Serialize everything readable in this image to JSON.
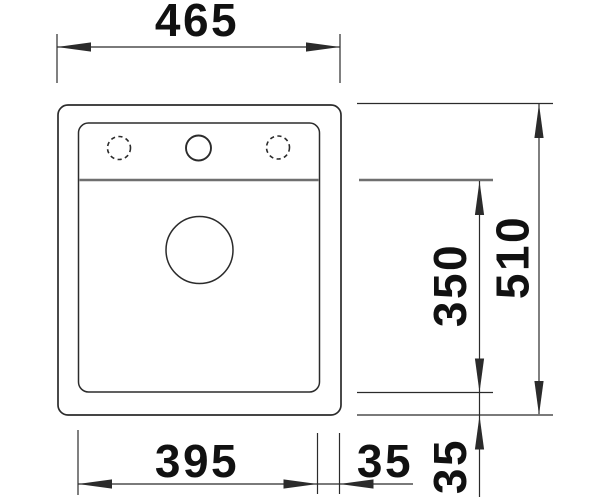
{
  "drawing": {
    "kind": "sink-installation-dimension-drawing",
    "view": "top",
    "labels": {
      "total_width": "465",
      "total_depth": "510",
      "bowl_depth": "350",
      "bowl_width": "395",
      "rim_right": "35",
      "rim_bottom": "35"
    },
    "colors": {
      "background": "#ffffff",
      "outline": "#2b2b2b",
      "divider": "#6f6f6f",
      "dimension_line": "#2b2b2b",
      "text": "#111111"
    }
  }
}
